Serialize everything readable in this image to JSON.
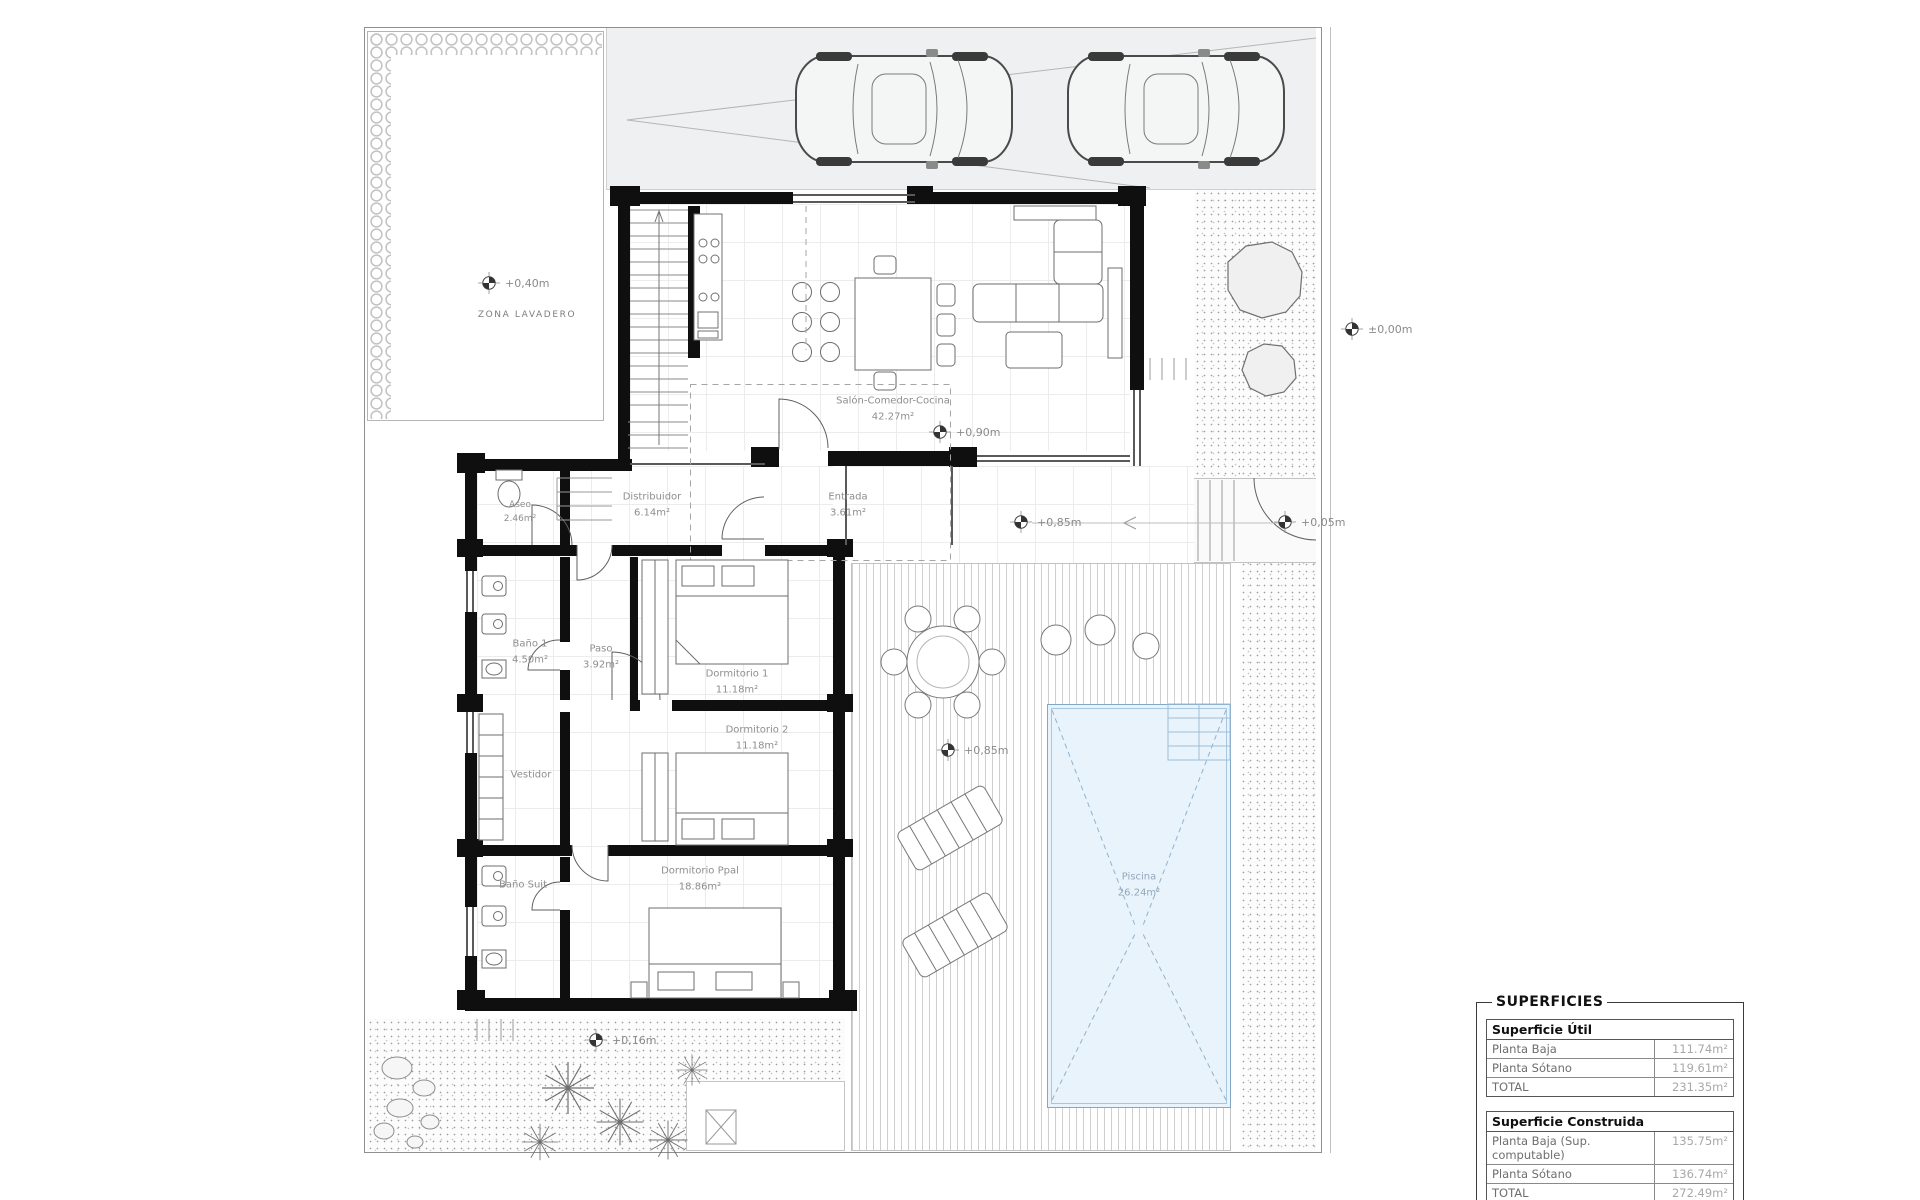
{
  "drawing": {
    "type": "floor-plan",
    "floor": "planta baja"
  },
  "colors": {
    "wall": "#0f0f0f",
    "linework": "#9a9a9a",
    "pool_fill": "#e9f3fb",
    "pool_line": "#7fa8c9",
    "driveway": "#eef0f1",
    "paper": "#ffffff"
  },
  "rooms": {
    "lavadero": {
      "name": "ZONA LAVADERO"
    },
    "salon": {
      "name": "Salón-Comedor-Cocina",
      "area": "42.27m²"
    },
    "distribuidor": {
      "name": "Distribuidor",
      "area": "6.14m²"
    },
    "entrada": {
      "name": "Entrada",
      "area": "3.61m²"
    },
    "aseo": {
      "name": "Aseo",
      "area": "2.46m²"
    },
    "bano1": {
      "name": "Baño 1",
      "area": "4.50m²"
    },
    "paso": {
      "name": "Paso",
      "area": "3.92m²"
    },
    "dorm1": {
      "name": "Dormitorio 1",
      "area": "11.18m²"
    },
    "dorm2": {
      "name": "Dormitorio 2",
      "area": "11.18m²"
    },
    "vestidor": {
      "name": "Vestidor"
    },
    "banosuit": {
      "name": "Baño Suit"
    },
    "dormppal": {
      "name": "Dormitorio Ppal",
      "area": "18.86m²"
    },
    "piscina": {
      "name": "Piscina",
      "area": "26.24m²"
    }
  },
  "levels": {
    "garden": "+0,40m",
    "street": "±0,00m",
    "salon": "+0,90m",
    "path_a": "+0,85m",
    "path_b": "+0,05m",
    "terrace": "+0,85m",
    "back": "+0,16m"
  },
  "surfaces": {
    "title": "SUPERFICIES",
    "util": {
      "header": "Superficie Útil",
      "rows": [
        {
          "label": "Planta Baja",
          "value": "111.74m²"
        },
        {
          "label": "Planta Sótano",
          "value": "119.61m²"
        },
        {
          "label": "TOTAL",
          "value": "231.35m²"
        }
      ]
    },
    "construida": {
      "header": "Superficie Construida",
      "rows": [
        {
          "label": "Planta Baja (Sup. computable)",
          "value": "135.75m²"
        },
        {
          "label": "Planta Sótano",
          "value": "136.74m²"
        },
        {
          "label": "TOTAL",
          "value": "272.49m²"
        }
      ]
    }
  }
}
